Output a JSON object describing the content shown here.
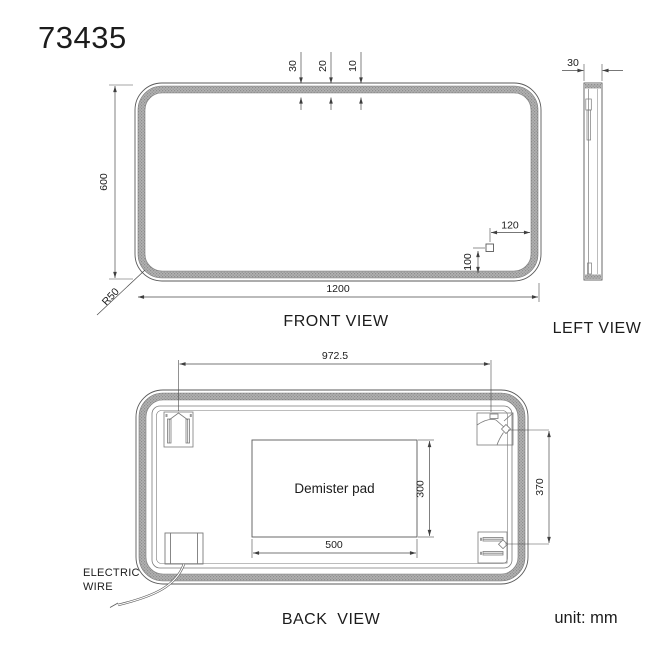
{
  "title": "73435",
  "unit": "unit: mm",
  "colors": {
    "line": "#5a5a5a",
    "band": "#aeaeae",
    "text": "#1c1c1c"
  },
  "front_view": {
    "label": "FRONT VIEW",
    "dims": {
      "width": "1200",
      "height": "600",
      "top_outer": "30",
      "top_mid": "20",
      "top_inner": "10",
      "corner_radius": "R50",
      "sensor_from_right": "120",
      "sensor_from_bottom": "100"
    }
  },
  "left_view": {
    "label": "LEFT VIEW",
    "dims": {
      "thickness": "30"
    }
  },
  "back_view": {
    "label": "BACK  VIEW",
    "demister_label": "Demister pad",
    "wire_label_line1": "ELECTRIC",
    "wire_label_line2": "WIRE",
    "dims": {
      "bracket_span": "972.5",
      "bracket_vertical_span": "370",
      "pad_width": "500",
      "pad_height": "300"
    }
  }
}
